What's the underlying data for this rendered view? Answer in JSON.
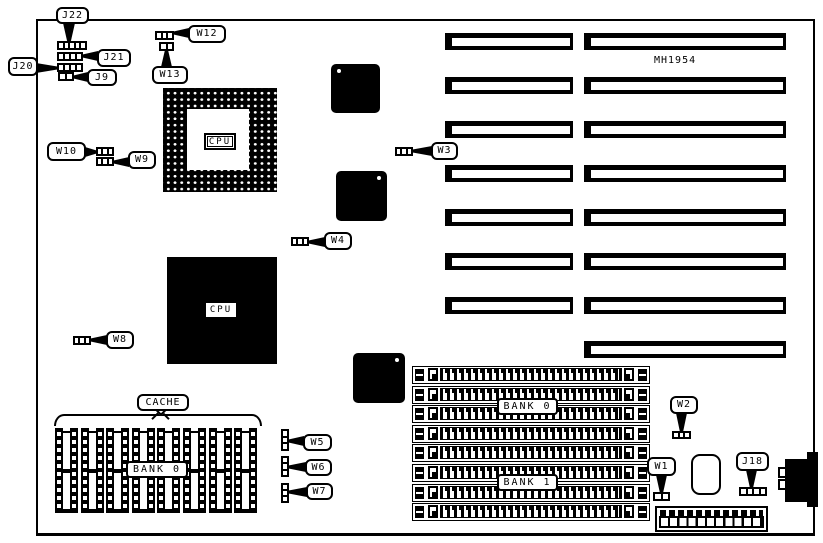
{
  "board": {
    "part_number": "MH1954"
  },
  "cpu_socket": {
    "label": "CPU"
  },
  "cpu_chip": {
    "label": "CPU"
  },
  "cache": {
    "label": "CACHE",
    "bank_label": "BANK 0"
  },
  "memory": {
    "bank0_label": "BANK 0",
    "bank1_label": "BANK 1",
    "simm_count": 8
  },
  "isa_slots": {
    "left": {
      "x": 445,
      "w": 128,
      "count": 7
    },
    "right": {
      "x": 584,
      "w": 202,
      "count": 8
    },
    "y0": 33,
    "dy": 44,
    "h": 17
  },
  "simm_geometry": {
    "x": 412,
    "w": 238,
    "y0": 366,
    "dy": 19.6,
    "h": 18,
    "count": 8
  },
  "cache_geometry": {
    "x0": 55,
    "dx": 25.6,
    "w": 23,
    "y": 428,
    "h": 85,
    "count": 8
  },
  "misc_chips": [
    {
      "x": 331,
      "y": 64,
      "w": 49,
      "h": 49,
      "dot": "tl"
    },
    {
      "x": 336,
      "y": 171,
      "w": 51,
      "h": 50,
      "dot": "tr"
    },
    {
      "x": 353,
      "y": 353,
      "w": 52,
      "h": 50,
      "dot": "tr"
    }
  ],
  "jumpers": [
    {
      "id": "j22",
      "text": "J22",
      "label": [
        56,
        7,
        33,
        17
      ],
      "header": [
        57,
        41,
        30,
        9
      ],
      "pins": 5,
      "dir": "h",
      "stem": [
        63,
        23,
        12,
        19
      ],
      "stem_dir": "up"
    },
    {
      "id": "j21",
      "text": "J21",
      "label": [
        97,
        49,
        34,
        18
      ],
      "header": [
        57,
        52,
        26,
        9
      ],
      "pins": 4,
      "dir": "h",
      "stem": [
        82,
        51,
        16,
        10
      ],
      "stem_dir": "right"
    },
    {
      "id": "j20",
      "text": "J20",
      "label": [
        8,
        57,
        30,
        19
      ],
      "header": [
        57,
        63,
        26,
        9
      ],
      "pins": 4,
      "dir": "h",
      "stem": [
        36,
        63,
        22,
        10
      ],
      "stem_dir": "left"
    },
    {
      "id": "j9",
      "text": "J9",
      "label": [
        87,
        69,
        30,
        17
      ],
      "header": [
        58,
        72,
        16,
        9
      ],
      "pins": 2,
      "dir": "h",
      "stem": [
        73,
        72,
        15,
        10
      ],
      "stem_dir": "right"
    },
    {
      "id": "w12",
      "text": "W12",
      "label": [
        188,
        25,
        38,
        18
      ],
      "header": [
        155,
        31,
        19,
        9
      ],
      "pins": 3,
      "dir": "h",
      "stem": [
        173,
        28,
        16,
        10
      ],
      "stem_dir": "right"
    },
    {
      "id": "w13",
      "text": "W13",
      "label": [
        152,
        66,
        36,
        18
      ],
      "header": [
        159,
        42,
        15,
        9
      ],
      "pins": 2,
      "dir": "h",
      "stem": [
        161,
        50,
        11,
        17
      ],
      "stem_dir": "down"
    },
    {
      "id": "w10",
      "text": "W10",
      "label": [
        47,
        142,
        39,
        19
      ],
      "header": [
        96,
        147,
        18,
        9
      ],
      "pins": 3,
      "dir": "h",
      "stem": [
        85,
        147,
        12,
        10
      ],
      "stem_dir": "left"
    },
    {
      "id": "w9",
      "text": "W9",
      "label": [
        128,
        151,
        28,
        18
      ],
      "header": [
        96,
        157,
        18,
        9
      ],
      "pins": 3,
      "dir": "h",
      "stem": [
        113,
        157,
        16,
        10
      ],
      "stem_dir": "right"
    },
    {
      "id": "w3",
      "text": "W3",
      "label": [
        431,
        142,
        27,
        18
      ],
      "header": [
        395,
        147,
        18,
        9
      ],
      "pins": 3,
      "dir": "h",
      "stem": [
        412,
        146,
        20,
        10
      ],
      "stem_dir": "right"
    },
    {
      "id": "w4",
      "text": "W4",
      "label": [
        324,
        232,
        28,
        18
      ],
      "header": [
        291,
        237,
        18,
        9
      ],
      "pins": 3,
      "dir": "h",
      "stem": [
        308,
        237,
        17,
        10
      ],
      "stem_dir": "right"
    },
    {
      "id": "w8",
      "text": "W8",
      "label": [
        106,
        331,
        28,
        18
      ],
      "header": [
        73,
        336,
        18,
        9
      ],
      "pins": 3,
      "dir": "h",
      "stem": [
        90,
        335,
        17,
        10
      ],
      "stem_dir": "right"
    },
    {
      "id": "w5",
      "text": "W5",
      "label": [
        303,
        434,
        29,
        17
      ],
      "header": [
        281,
        429,
        8,
        22
      ],
      "pins": 3,
      "dir": "v",
      "stem": [
        288,
        436,
        16,
        10
      ],
      "stem_dir": "right"
    },
    {
      "id": "w6",
      "text": "W6",
      "label": [
        305,
        459,
        27,
        17
      ],
      "header": [
        281,
        456,
        8,
        21
      ],
      "pins": 3,
      "dir": "v",
      "stem": [
        288,
        462,
        18,
        10
      ],
      "stem_dir": "right"
    },
    {
      "id": "w7",
      "text": "W7",
      "label": [
        306,
        483,
        27,
        17
      ],
      "header": [
        281,
        483,
        8,
        20
      ],
      "pins": 3,
      "dir": "v",
      "stem": [
        288,
        487,
        19,
        10
      ],
      "stem_dir": "right"
    },
    {
      "id": "w2",
      "text": "W2",
      "label": [
        670,
        396,
        28,
        18
      ],
      "header": [
        672,
        431,
        19,
        8
      ],
      "pins": 3,
      "dir": "h",
      "stem": [
        676,
        413,
        11,
        19
      ],
      "stem_dir": "up"
    },
    {
      "id": "w1",
      "text": "W1",
      "label": [
        647,
        457,
        29,
        19
      ],
      "header": [
        653,
        492,
        17,
        9
      ],
      "pins": 2,
      "dir": "h",
      "stem": [
        656,
        475,
        11,
        18
      ],
      "stem_dir": "up"
    },
    {
      "id": "j18",
      "text": "J18",
      "label": [
        736,
        452,
        33,
        19
      ],
      "header": [
        739,
        487,
        28,
        9
      ],
      "pins": 4,
      "dir": "h",
      "stem": [
        746,
        470,
        11,
        18
      ],
      "stem_dir": "up"
    }
  ]
}
